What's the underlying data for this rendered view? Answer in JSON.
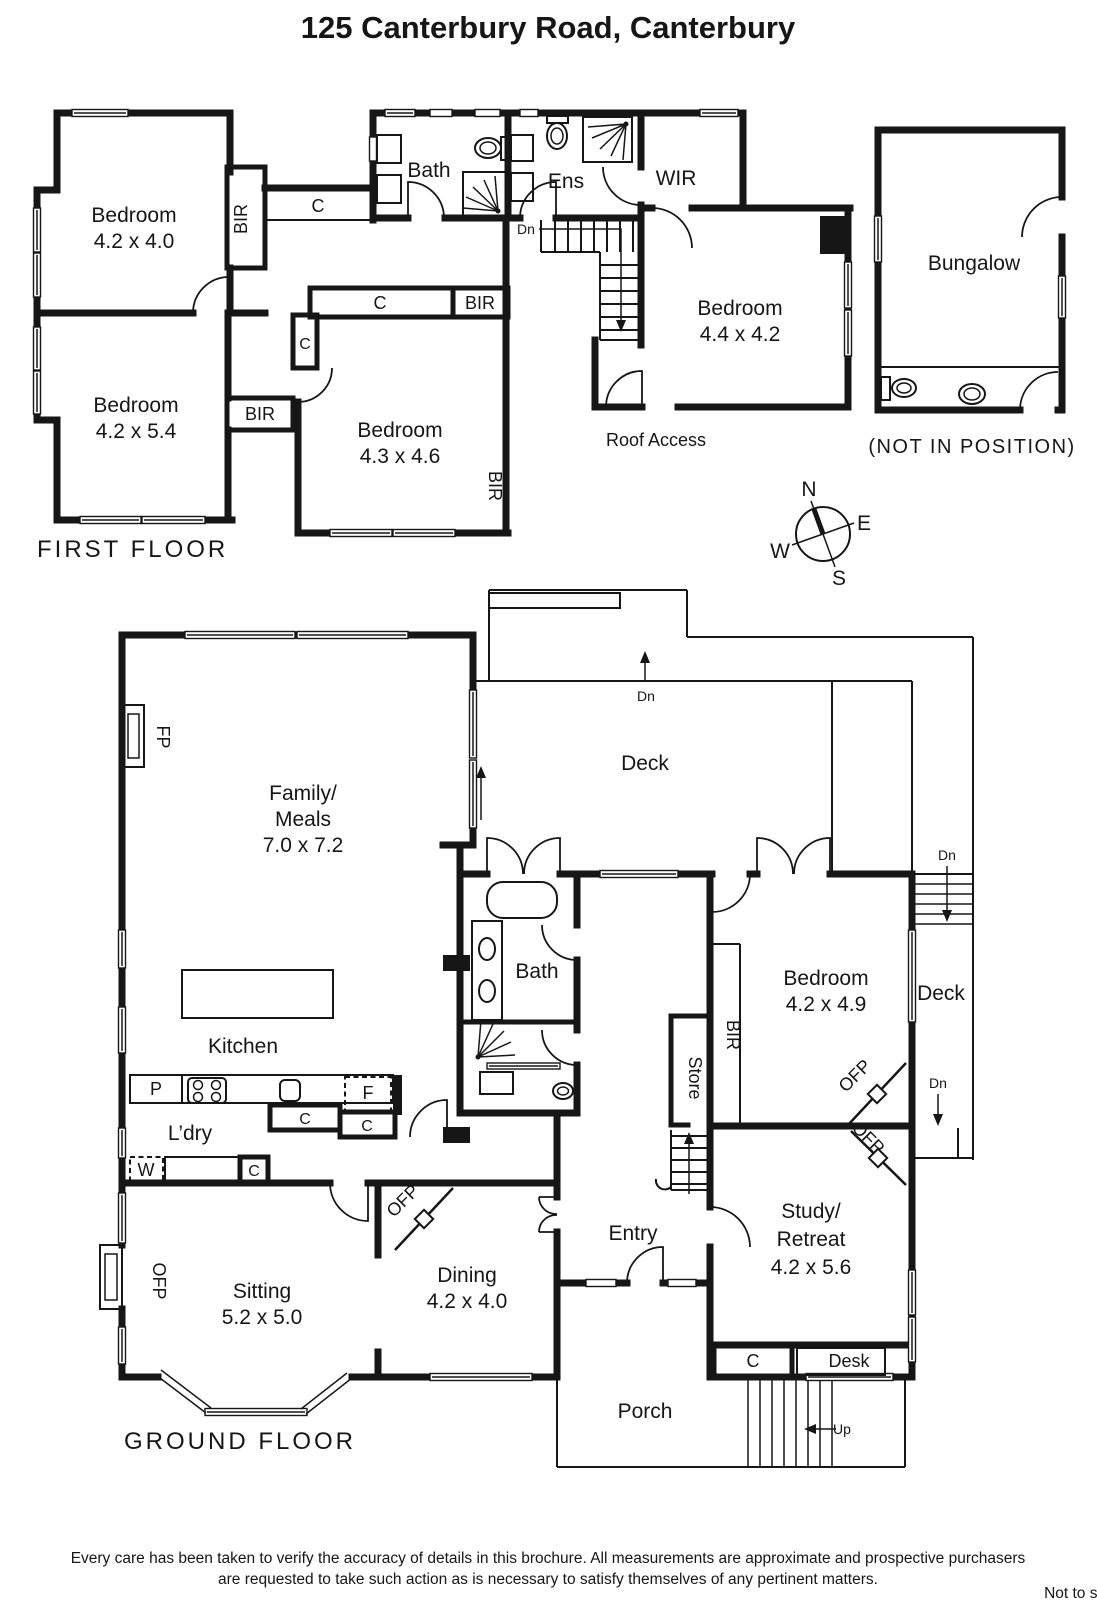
{
  "title": "125 Canterbury Road, Canterbury",
  "first_floor": {
    "label": "FIRST FLOOR",
    "bedroom1": {
      "name": "Bedroom",
      "dims": "4.2 x 4.0"
    },
    "bedroom2": {
      "name": "Bedroom",
      "dims": "4.2 x 5.4"
    },
    "bedroom3": {
      "name": "Bedroom",
      "dims": "4.3 x 4.6"
    },
    "bedroom4": {
      "name": "Bedroom",
      "dims": "4.4 x 4.2"
    },
    "bath": "Bath",
    "ens": "Ens",
    "wir": "WIR",
    "bungalow": "Bungalow",
    "bungalow_note": "(NOT IN POSITION)",
    "roof_access": "Roof Access"
  },
  "ground_floor": {
    "label": "GROUND FLOOR",
    "family": {
      "line1": "Family/",
      "line2": "Meals",
      "dims": "7.0 x 7.2"
    },
    "kitchen": "Kitchen",
    "laundry": "L’dry",
    "sitting": {
      "name": "Sitting",
      "dims": "5.2 x 5.0"
    },
    "dining": {
      "name": "Dining",
      "dims": "4.2 x 4.0"
    },
    "entry": "Entry",
    "study": {
      "line1": "Study/",
      "line2": "Retreat",
      "dims": "4.2 x 5.6"
    },
    "bedroom": {
      "name": "Bedroom",
      "dims": "4.2 x 4.9"
    },
    "bath": "Bath",
    "deck": "Deck",
    "porch": "Porch",
    "store": "Store",
    "desk": "Desk"
  },
  "markers": {
    "bir": "BIR",
    "cupboard": "C",
    "ofp": "OFP",
    "fp": "FP",
    "dn": "Dn",
    "up": "Up",
    "pantry": "P",
    "fridge": "F",
    "washer": "W"
  },
  "compass": {
    "n": "N",
    "e": "E",
    "s": "S",
    "w": "W"
  },
  "footer": {
    "line1": "Every care has been taken to verify the accuracy of details in this brochure.  All measurements are approximate and prospective purchasers",
    "line2": "are requested to take such action as is necessary to satisfy themselves of any pertinent matters.",
    "scale_note": "Not to scale"
  }
}
